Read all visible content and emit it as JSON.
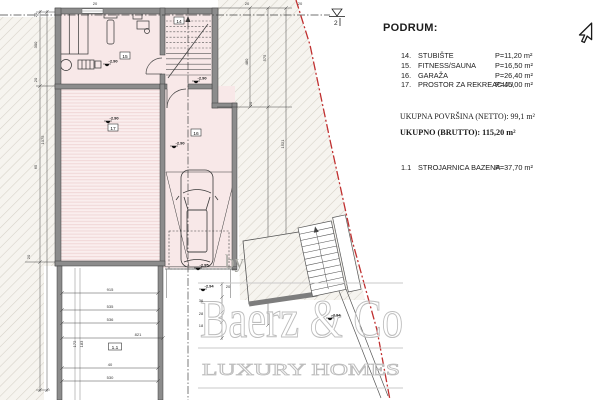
{
  "legend": {
    "heading": "PODRUM:",
    "items": [
      {
        "num": "14.",
        "name": "STUBIŠTE",
        "area": "P=11,20 m²"
      },
      {
        "num": "15.",
        "name": "FITNESS/SAUNA",
        "area": "P=16,50 m²"
      },
      {
        "num": "16.",
        "name": "GARAŽA",
        "area": "P=26,40 m²"
      },
      {
        "num": "17.",
        "name": "PROSTOR ZA REKREACIJU",
        "area": "P=45,00 m²"
      }
    ],
    "netto": "UKUPNA POVRŠINA (NETTO): 99,1 m²",
    "brutto": "UKUPNO (BRUTTO): 115,20 m²",
    "extra": {
      "num": "1.1",
      "name": "STROJARNICA BAZENA",
      "area": "P=37,70 m²"
    }
  },
  "watermark": {
    "by": "by",
    "brand": "Baerz & Co",
    "tagline": "LUXURY HOMES"
  },
  "plan": {
    "section_label": "2",
    "room_labels": [
      {
        "x": 179,
        "y": 22,
        "t": "14"
      },
      {
        "x": 125,
        "y": 57,
        "t": "15"
      },
      {
        "x": 196,
        "y": 134,
        "t": "16"
      },
      {
        "x": 113,
        "y": 129,
        "t": "17"
      },
      {
        "x": 115,
        "y": 348,
        "t": "1.1",
        "w": 13
      }
    ],
    "elevation_markers": [
      {
        "x": 107,
        "y": 64,
        "v": "-2.90"
      },
      {
        "x": 196,
        "y": 81,
        "v": "-2.90"
      },
      {
        "x": 108,
        "y": 121,
        "v": "-2.90"
      },
      {
        "x": 174,
        "y": 146,
        "v": "-2.90"
      },
      {
        "x": 198,
        "y": 268,
        "v": "-2.95"
      },
      {
        "x": 203,
        "y": 289,
        "v": "-2.94"
      },
      {
        "x": 330,
        "y": 318,
        "v": "-2.94"
      }
    ],
    "dim_labels": [
      {
        "x": 37,
        "y": 15,
        "t": "20",
        "rot": -90
      },
      {
        "x": 37,
        "y": 45,
        "t": "300",
        "rot": -90
      },
      {
        "x": 37,
        "y": 80,
        "t": "20",
        "rot": -90
      },
      {
        "x": 44,
        "y": 140,
        "t": "1075",
        "rot": -90
      },
      {
        "x": 37,
        "y": 167,
        "t": "65",
        "rot": -90
      },
      {
        "x": 30,
        "y": 257,
        "t": "20",
        "rot": -90
      },
      {
        "x": 248,
        "y": 62,
        "t": "480",
        "rot": -90
      },
      {
        "x": 266,
        "y": 58,
        "t": "575",
        "rot": -90
      },
      {
        "x": 284,
        "y": 144,
        "t": "1521",
        "rot": -90
      },
      {
        "x": 252,
        "y": 104,
        "t": "20",
        "rot": -90
      },
      {
        "x": 247,
        "y": 5,
        "t": "20"
      },
      {
        "x": 300,
        "y": 5,
        "t": "20"
      },
      {
        "x": 95,
        "y": 5,
        "t": "20"
      },
      {
        "x": 110,
        "y": 291,
        "t": "915"
      },
      {
        "x": 110,
        "y": 308,
        "t": "535"
      },
      {
        "x": 110,
        "y": 321,
        "t": "536"
      },
      {
        "x": 138,
        "y": 336,
        "t": "821"
      },
      {
        "x": 110,
        "y": 366,
        "t": "40"
      },
      {
        "x": 110,
        "y": 379,
        "t": "530"
      },
      {
        "x": 76,
        "y": 344,
        "t": "172",
        "rot": -90
      },
      {
        "x": 83,
        "y": 344,
        "t": "183",
        "rot": -90
      },
      {
        "x": 201,
        "y": 302,
        "t": "36"
      },
      {
        "x": 201,
        "y": 315,
        "t": "28"
      },
      {
        "x": 201,
        "y": 327,
        "t": "18"
      },
      {
        "x": 228,
        "y": 288,
        "t": "20"
      }
    ]
  }
}
